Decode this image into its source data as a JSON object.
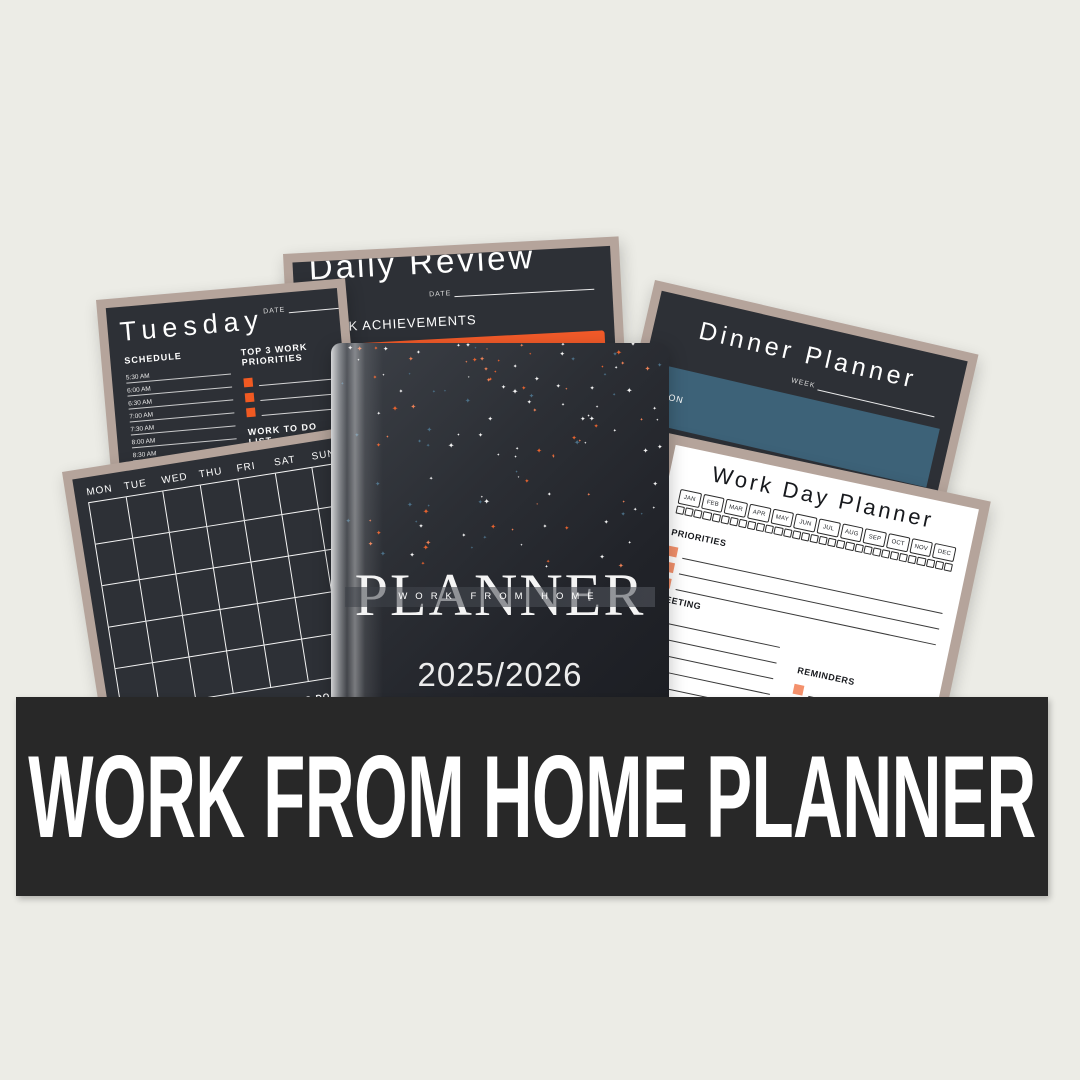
{
  "colors": {
    "background": "#ecece6",
    "page_dark": "#2d3036",
    "frame": "#b5a49b",
    "accent_orange": "#f15a22",
    "panel_orange": "#f15a29",
    "steel_blue": "#3d6278",
    "salmon": "#f4916c",
    "white_page": "#ffffff",
    "ink": "#1d2024",
    "banner_bg": "#282828"
  },
  "banner": {
    "text": "WORK FROM HOME PLANNER"
  },
  "cover": {
    "title": "PLANNER",
    "subtitle": "WORK FROM HOME",
    "years": "2025/2026",
    "stars": {
      "count": 135,
      "colors": [
        "#f5f5f5",
        "#f5f5f5",
        "#ee8257",
        "#e8632f",
        "#4c7087"
      ]
    }
  },
  "tuesday_page": {
    "title": "Tuesday",
    "date_label": "DATE",
    "schedule_label": "SCHEDULE",
    "times": [
      "5:30 AM",
      "6:00 AM",
      "6:30 AM",
      "7:00 AM",
      "7:30 AM",
      "8:00 AM",
      "8:30 AM",
      "9:00 AM",
      "9:30 AM",
      "10:00 AM",
      "10:30 AM",
      "11:00 AM",
      "11:30 AM",
      "12:00 PM",
      "12:30 PM"
    ],
    "priorities_label": "TOP 3 WORK PRIORITIES",
    "priorities_rows": 3,
    "todo_label": "WORK TO DO LIST",
    "todo_rows": 8
  },
  "daily_review_page": {
    "title": "Daily Review",
    "date_label": "DATE",
    "achievements_label": "WORK ACHIEVEMENTS",
    "panel_lines": 4
  },
  "dinner_planner_page": {
    "title": "Dinner Planner",
    "week_label": "WEEK",
    "days": [
      "MON",
      "TUE",
      "WED",
      "THU",
      "FRI"
    ]
  },
  "work_day_planner_page": {
    "title": "Work Day Planner",
    "months": [
      "JAN",
      "FEB",
      "MAR",
      "APR",
      "MAY",
      "JUN",
      "JUL",
      "AUG",
      "SEP",
      "OCT",
      "NOV",
      "DEC"
    ],
    "day_boxes": 31,
    "priorities": {
      "label": "PRIORITIES",
      "rows": 3
    },
    "left_sections": [
      {
        "label": "MEETING",
        "rows": 6
      },
      {
        "label": "CALL",
        "rows": 4
      },
      {
        "label": "EMAIL",
        "rows": 2
      }
    ],
    "right_sections": [
      {
        "label": "REMINDERS",
        "rows": 4
      },
      {
        "label": "FOLLOW UP",
        "rows": 3
      }
    ]
  },
  "calendar_page": {
    "weekdays": [
      "MON",
      "TUE",
      "WED",
      "THU",
      "FRI",
      "SAT",
      "SUN"
    ],
    "grid_rows": 5,
    "grid_cols": 7,
    "personal_label": "PERSONAL TO DO LIST",
    "personal_rows": 3,
    "work_label": "WORK TO DO LIST",
    "work_rows": 4
  }
}
